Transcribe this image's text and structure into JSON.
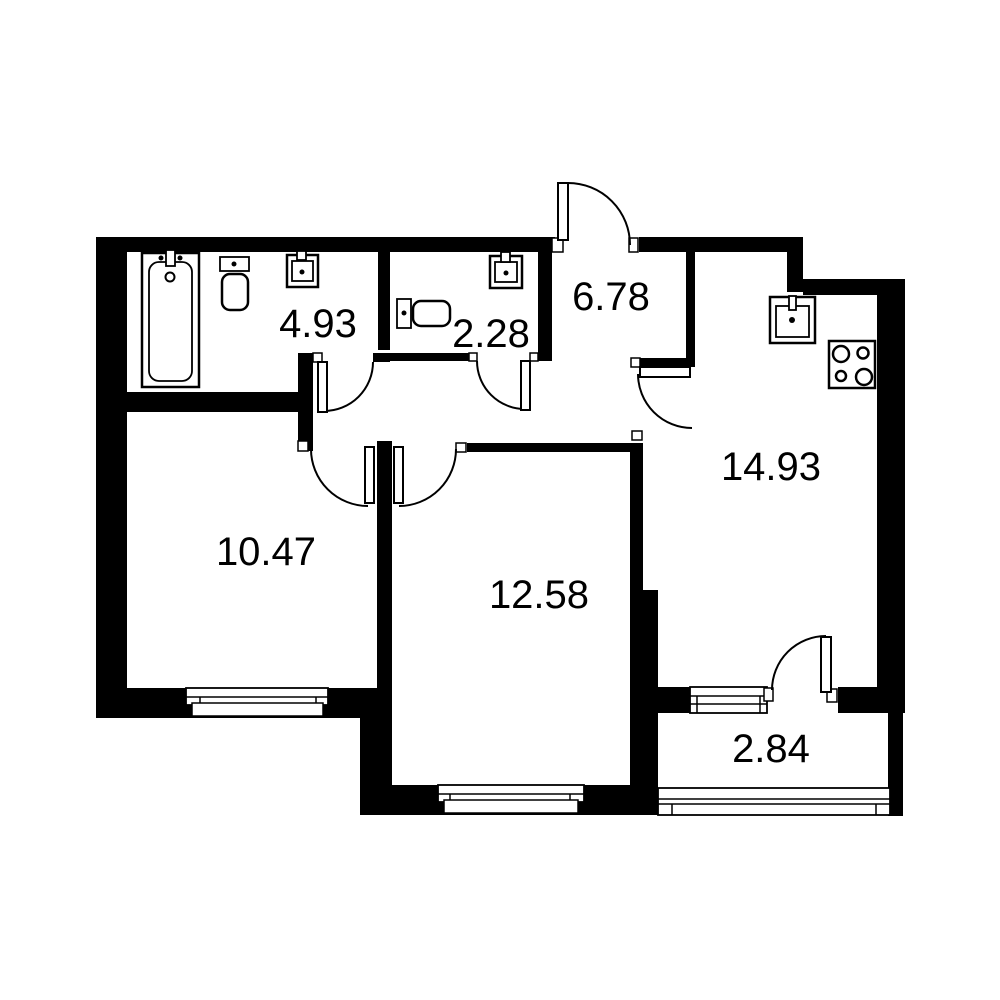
{
  "title": "Apartment floor plan",
  "area_unit_implied": "m2",
  "colors": {
    "walls": "#000000",
    "background": "#ffffff",
    "text": "#000000"
  },
  "rooms": [
    {
      "id": "bathroom",
      "label": "4.93"
    },
    {
      "id": "wc",
      "label": "2.28"
    },
    {
      "id": "hallway",
      "label": "6.78"
    },
    {
      "id": "kitchen",
      "label": "14.93"
    },
    {
      "id": "bedroom",
      "label": "10.47"
    },
    {
      "id": "living-room",
      "label": "12.58"
    },
    {
      "id": "balcony",
      "label": "2.84"
    }
  ],
  "fixtures": [
    "bathtub-icon",
    "toilet-icon",
    "sink-icon",
    "toilet-icon",
    "sink-icon",
    "kitchen-sink-icon",
    "stove-icon"
  ],
  "doors": [
    "entrance-door",
    "bathroom-door",
    "wc-door",
    "kitchen-door",
    "bedroom-door",
    "living-room-door",
    "balcony-door"
  ],
  "windows": [
    "bedroom-window",
    "living-room-window",
    "balcony-window",
    "balcony-glazing"
  ]
}
